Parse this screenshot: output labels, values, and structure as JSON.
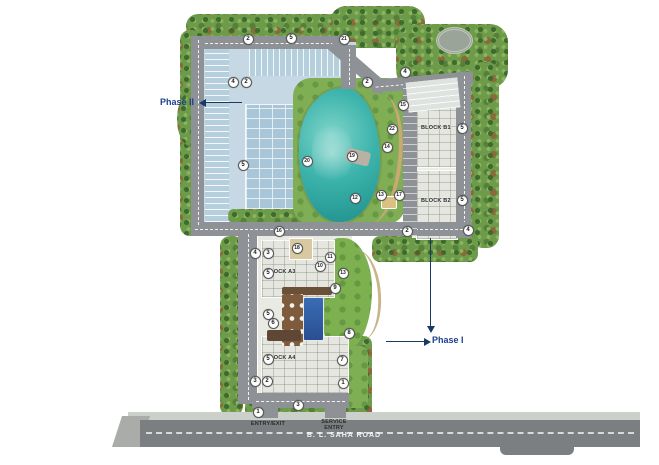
{
  "site": {
    "phase2_label": "Phase II",
    "phase1_label": "Phase I",
    "road_name": "B. L. SAHA ROAD",
    "entry_exit_label": "ENTRY/EXIT",
    "service_entry_label": "SERVICE ENTRY"
  },
  "blocks": [
    {
      "label": "BLOCK B1",
      "x": 421,
      "y": 128
    },
    {
      "label": "BLOCK B2",
      "x": 421,
      "y": 201
    },
    {
      "label": "BLOCK A3",
      "x": 266,
      "y": 272
    },
    {
      "label": "BLOCK A4",
      "x": 266,
      "y": 358
    }
  ],
  "markers": [
    {
      "n": "2",
      "x": 248,
      "y": 39
    },
    {
      "n": "5",
      "x": 291,
      "y": 38
    },
    {
      "n": "21",
      "x": 344,
      "y": 39
    },
    {
      "n": "4",
      "x": 233,
      "y": 82
    },
    {
      "n": "2",
      "x": 246,
      "y": 82
    },
    {
      "n": "2",
      "x": 367,
      "y": 82
    },
    {
      "n": "4",
      "x": 405,
      "y": 72
    },
    {
      "n": "15",
      "x": 403,
      "y": 105
    },
    {
      "n": "22",
      "x": 392,
      "y": 129
    },
    {
      "n": "14",
      "x": 387,
      "y": 147
    },
    {
      "n": "19",
      "x": 352,
      "y": 156
    },
    {
      "n": "20",
      "x": 307,
      "y": 161
    },
    {
      "n": "5",
      "x": 243,
      "y": 165
    },
    {
      "n": "12",
      "x": 355,
      "y": 198
    },
    {
      "n": "13",
      "x": 381,
      "y": 195
    },
    {
      "n": "17",
      "x": 399,
      "y": 195
    },
    {
      "n": "5",
      "x": 462,
      "y": 128
    },
    {
      "n": "5",
      "x": 462,
      "y": 200
    },
    {
      "n": "2",
      "x": 407,
      "y": 231
    },
    {
      "n": "4",
      "x": 468,
      "y": 230
    },
    {
      "n": "16",
      "x": 279,
      "y": 231
    },
    {
      "n": "18",
      "x": 297,
      "y": 248
    },
    {
      "n": "4",
      "x": 255,
      "y": 253
    },
    {
      "n": "3",
      "x": 268,
      "y": 253
    },
    {
      "n": "11",
      "x": 330,
      "y": 257
    },
    {
      "n": "10",
      "x": 320,
      "y": 266
    },
    {
      "n": "13",
      "x": 343,
      "y": 273
    },
    {
      "n": "9",
      "x": 335,
      "y": 288
    },
    {
      "n": "5",
      "x": 268,
      "y": 273
    },
    {
      "n": "5",
      "x": 268,
      "y": 314
    },
    {
      "n": "6",
      "x": 273,
      "y": 323
    },
    {
      "n": "8",
      "x": 349,
      "y": 333
    },
    {
      "n": "5",
      "x": 268,
      "y": 359
    },
    {
      "n": "7",
      "x": 342,
      "y": 360
    },
    {
      "n": "3",
      "x": 255,
      "y": 381
    },
    {
      "n": "2",
      "x": 267,
      "y": 381
    },
    {
      "n": "1",
      "x": 343,
      "y": 383
    },
    {
      "n": "3",
      "x": 298,
      "y": 405
    },
    {
      "n": "1",
      "x": 258,
      "y": 412
    }
  ],
  "colors": {
    "accent_blue": "#1d3e8c",
    "arrow_navy": "#183a63",
    "lake_teal": "#2ca39e",
    "road_gray": "#8e9297",
    "main_road_gray": "#7b7f82",
    "grass_green": "#7fae54",
    "foliage_green": "#6d9b4a",
    "parking_blue": "#b5cfdd",
    "pool_blue": "#33589f",
    "deck_brown": "#7e5b3d"
  }
}
